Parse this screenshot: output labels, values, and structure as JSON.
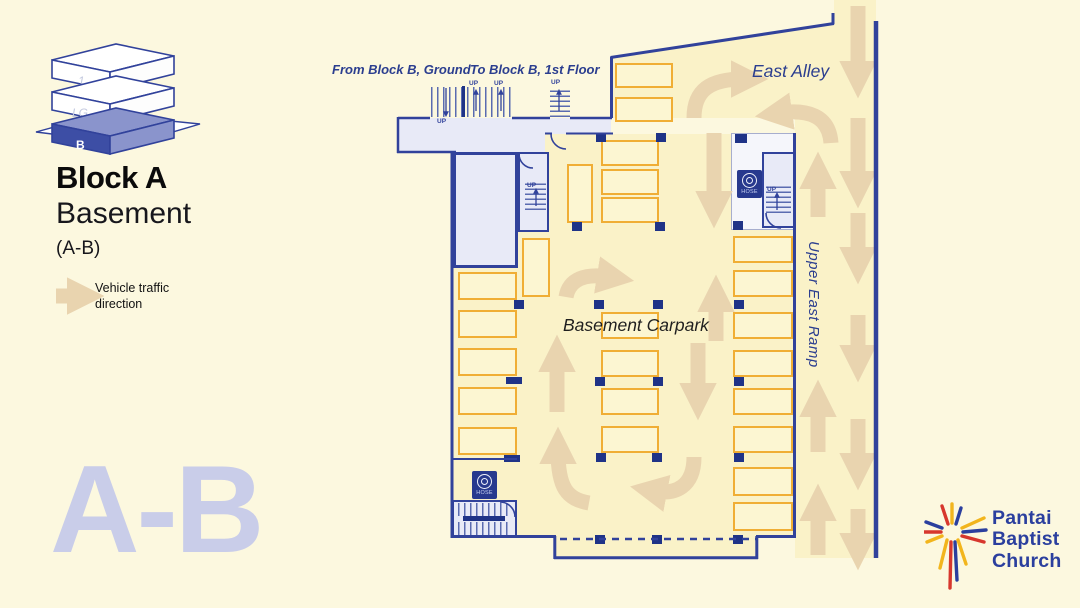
{
  "colors": {
    "page_bg": "#FCF8DF",
    "plan_fill": "#FAF2C8",
    "spot_fill": "#FCF6D2",
    "spot_border": "#F0AE35",
    "wall": "#31429B",
    "room_fill": "#E8EAF7",
    "outer_room_fill": "#F5F6FB",
    "outer_room_border": "#A7AECE",
    "arrow": "#E9D4AF",
    "watermark": "#C9CDE9",
    "label_navy": "#2B3E8F",
    "hose_bg": "#27398E",
    "pillar": "#1F3387",
    "stair_line": "#5A6BB0",
    "logo_blue": "#2B3F9E",
    "logo_red": "#D7372D",
    "logo_yellow": "#F2B51D",
    "iso_front": "#3D4EA5",
    "iso_side": "#8A94CC",
    "iso_label": "#C3C9DF"
  },
  "sidebar": {
    "building": "Block A",
    "level": "Basement",
    "code": "(A-B)",
    "legend": "Vehicle traffic\ndirection",
    "watermark": "A-B",
    "level_diagram": {
      "levels": [
        "1",
        "LG",
        "B"
      ],
      "active": "B"
    }
  },
  "logo": {
    "name": "Pantai\nBaptist\nChurch"
  },
  "plan": {
    "labels": {
      "carpark": "Basement Carpark",
      "east_alley": "East Alley",
      "upper_east_ramp": "Upper East Ramp",
      "from_block_b": "From Block B, Ground",
      "to_block_b": "To Block B, 1st Floor",
      "up": "UP",
      "hose": "HOSE"
    },
    "fills": [
      "M453,134 H795 V537 H453 Z",
      "M555,537 H757 V558 H555 Z",
      "M610,118 L610,57 L834,24 L834,0 L876,0 L876,558 L795,558 L795,118 Z"
    ],
    "rooms": [
      [
        398,
        118,
        147,
        34,
        "room_fill",
        "",
        0
      ],
      [
        545,
        118,
        66,
        16,
        "room_fill",
        "",
        0
      ],
      [
        453,
        152,
        65,
        116,
        "room_fill",
        "wall",
        3
      ],
      [
        518,
        152,
        31,
        80,
        "room_fill",
        "wall",
        2
      ],
      [
        731,
        133,
        65,
        97,
        "outer_room_fill",
        "outer_room_border",
        1.5
      ],
      [
        762,
        152,
        34,
        76,
        "room_fill",
        "wall",
        2.5
      ],
      [
        452,
        500,
        65,
        37,
        "room_fill",
        "wall",
        2.5
      ]
    ],
    "parking_spots": [
      [
        615,
        63,
        58,
        25
      ],
      [
        615,
        97,
        58,
        25
      ],
      [
        601,
        140,
        58,
        26
      ],
      [
        601,
        169,
        58,
        26
      ],
      [
        601,
        197,
        58,
        26
      ],
      [
        567,
        164,
        26,
        59
      ],
      [
        522,
        238,
        28,
        59
      ],
      [
        458,
        272,
        59,
        28
      ],
      [
        458,
        310,
        59,
        28
      ],
      [
        458,
        348,
        59,
        28
      ],
      [
        458,
        387,
        59,
        28
      ],
      [
        458,
        427,
        59,
        28
      ],
      [
        601,
        312,
        58,
        27
      ],
      [
        601,
        350,
        58,
        27
      ],
      [
        601,
        388,
        58,
        27
      ],
      [
        601,
        426,
        58,
        27
      ],
      [
        733,
        236,
        60,
        27
      ],
      [
        733,
        270,
        60,
        27
      ],
      [
        733,
        312,
        60,
        27
      ],
      [
        733,
        350,
        60,
        27
      ],
      [
        733,
        388,
        60,
        27
      ],
      [
        733,
        426,
        60,
        27
      ],
      [
        733,
        467,
        60,
        29
      ],
      [
        733,
        502,
        60,
        29
      ]
    ],
    "pillars": [
      [
        596,
        133,
        10,
        9
      ],
      [
        656,
        133,
        10,
        9
      ],
      [
        735,
        134,
        12,
        9
      ],
      [
        572,
        222,
        10,
        9
      ],
      [
        655,
        222,
        10,
        9
      ],
      [
        733,
        221,
        10,
        9
      ],
      [
        514,
        300,
        10,
        9
      ],
      [
        594,
        300,
        10,
        9
      ],
      [
        653,
        300,
        10,
        9
      ],
      [
        734,
        300,
        10,
        9
      ],
      [
        506,
        377,
        16,
        7
      ],
      [
        595,
        377,
        10,
        9
      ],
      [
        653,
        377,
        10,
        9
      ],
      [
        734,
        377,
        10,
        9
      ],
      [
        504,
        455,
        16,
        7
      ],
      [
        596,
        453,
        10,
        9
      ],
      [
        652,
        453,
        10,
        9
      ],
      [
        734,
        453,
        10,
        9
      ],
      [
        595,
        535,
        10,
        9
      ],
      [
        652,
        535,
        10,
        9
      ],
      [
        733,
        535,
        10,
        9
      ],
      [
        462,
        86,
        3,
        31
      ],
      [
        463,
        516,
        42,
        5
      ]
    ],
    "stairs": [
      [
        431,
        87,
        80,
        30,
        "v"
      ],
      [
        550,
        87,
        20,
        30,
        "h"
      ],
      [
        525,
        181,
        21,
        29,
        "h"
      ],
      [
        766,
        184,
        25,
        29,
        "h"
      ],
      [
        458,
        503,
        52,
        13,
        "v"
      ],
      [
        458,
        522,
        52,
        13,
        "v"
      ]
    ],
    "hose_cabinets": [
      [
        472,
        471
      ],
      [
        737,
        170
      ]
    ],
    "up_marks": [
      [
        437,
        118
      ],
      [
        469,
        80
      ],
      [
        494,
        80
      ],
      [
        551,
        79
      ],
      [
        527,
        182
      ],
      [
        767,
        186
      ]
    ],
    "stair_arrows": [
      "M446,88 V113",
      "M476,111 V93",
      "M501,111 V93",
      "M559,111 V93",
      "M536,206 V192",
      "M777,210 V196"
    ],
    "traffic_arrows": [
      "M858,6 V74",
      "M858,118 V184",
      "M858,213 V260",
      "M858,315 V358",
      "M858,419 V466",
      "M858,509 V546",
      "M818,217 V176",
      "M818,452 V404",
      "M818,555 V508",
      "M714,133 V204",
      "M716,341 V299",
      "M698,343 V396",
      "M557,412 V359",
      "M694,118 C694,90 710,79 744,79",
      "M831,143 C829,115 807,109 779,113",
      "M566,297 C569,279 585,273 610,277",
      "M694,457 C694,487 675,495 654,491",
      "M589,503 C567,499 558,488 558,451",
      "M56,296 H80"
    ],
    "walls": [
      [
        "M398,118 H430",
        2.5
      ],
      [
        "M512,118 H550",
        2.5
      ],
      [
        "M570,118 H612",
        2.5
      ],
      [
        "M398,117 V153",
        2.5
      ],
      [
        "M397,152 H456",
        2.5
      ],
      [
        "M545,133.5 H552",
        2
      ],
      [
        "M566,133.5 H613",
        2
      ],
      [
        "M611.5,118 V57",
        3
      ],
      [
        "M610.5,57.5 L834,23.5",
        3
      ],
      [
        "M833,24 V13",
        3
      ],
      [
        "M452,151 V538",
        3
      ],
      [
        "M451,536.5 H556",
        3
      ],
      [
        "M554.8,536 V559",
        3
      ],
      [
        "M554,557.8 H758",
        3
      ],
      [
        "M756.8,559 V536",
        3
      ],
      [
        "M756,536.5 H796",
        3
      ],
      [
        "M794.5,133 V538",
        3
      ],
      [
        "M876,21 V558",
        4.5
      ],
      [
        "M453,459 H517",
        2
      ]
    ],
    "dashed_wall": "M560,539 H756",
    "door_arcs": [
      "M551,134 A15,15 0 0 0 566,149",
      "M519,154 A14,14 0 0 0 533,168",
      "M766,213 A15,15 0 0 0 781,228",
      "M500,502 A15,15 0 0 1 515,517"
    ]
  }
}
